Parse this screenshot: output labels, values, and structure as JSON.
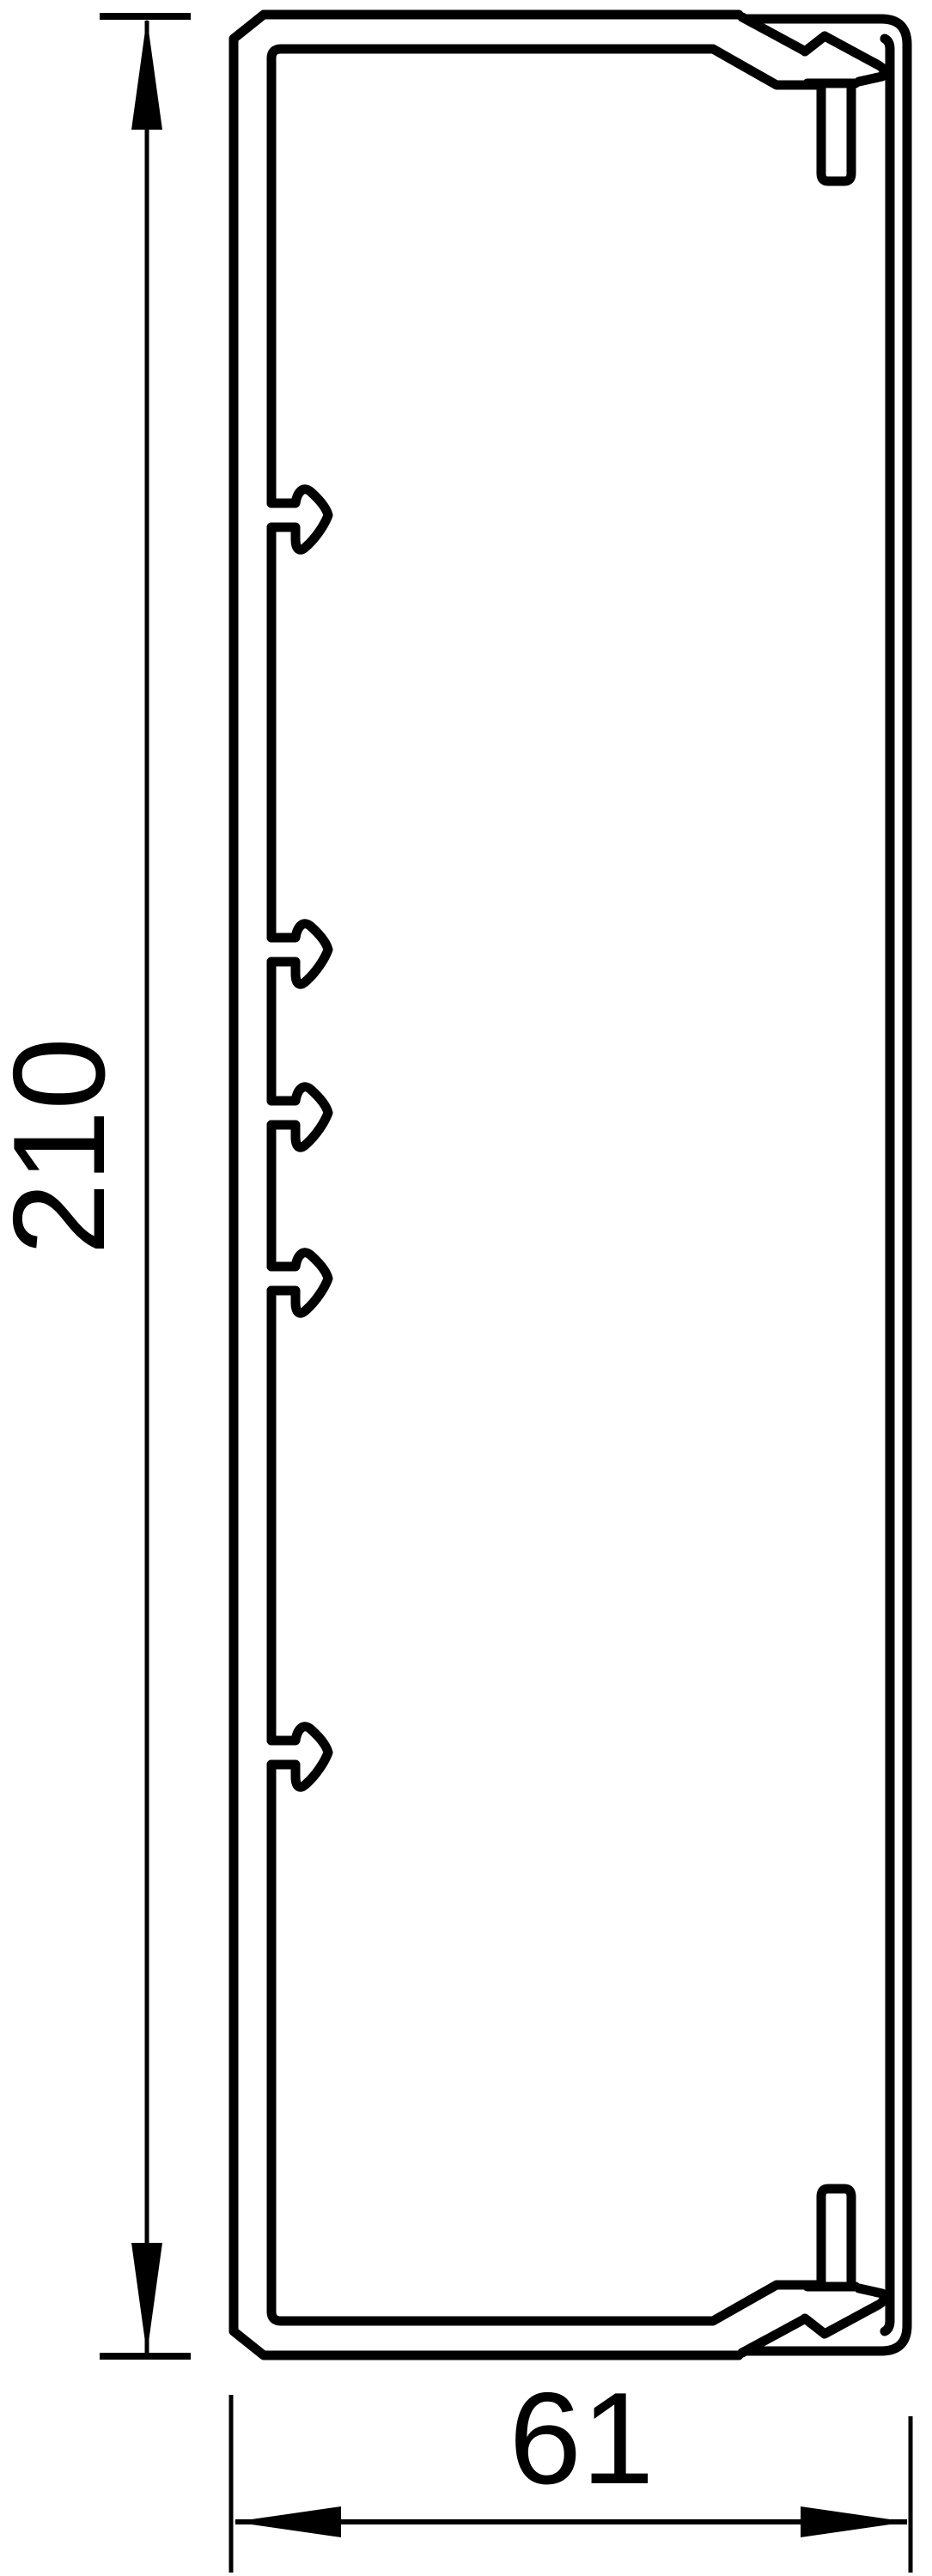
{
  "drawing": {
    "title": "cable-trunking-cross-section",
    "background_color": "#ffffff",
    "line_color": "#000000",
    "dimensions": {
      "height": {
        "label": "210",
        "orientation": "vertical"
      },
      "width": {
        "label": "61",
        "orientation": "horizontal"
      }
    },
    "features": {
      "hook_count": 5
    }
  }
}
